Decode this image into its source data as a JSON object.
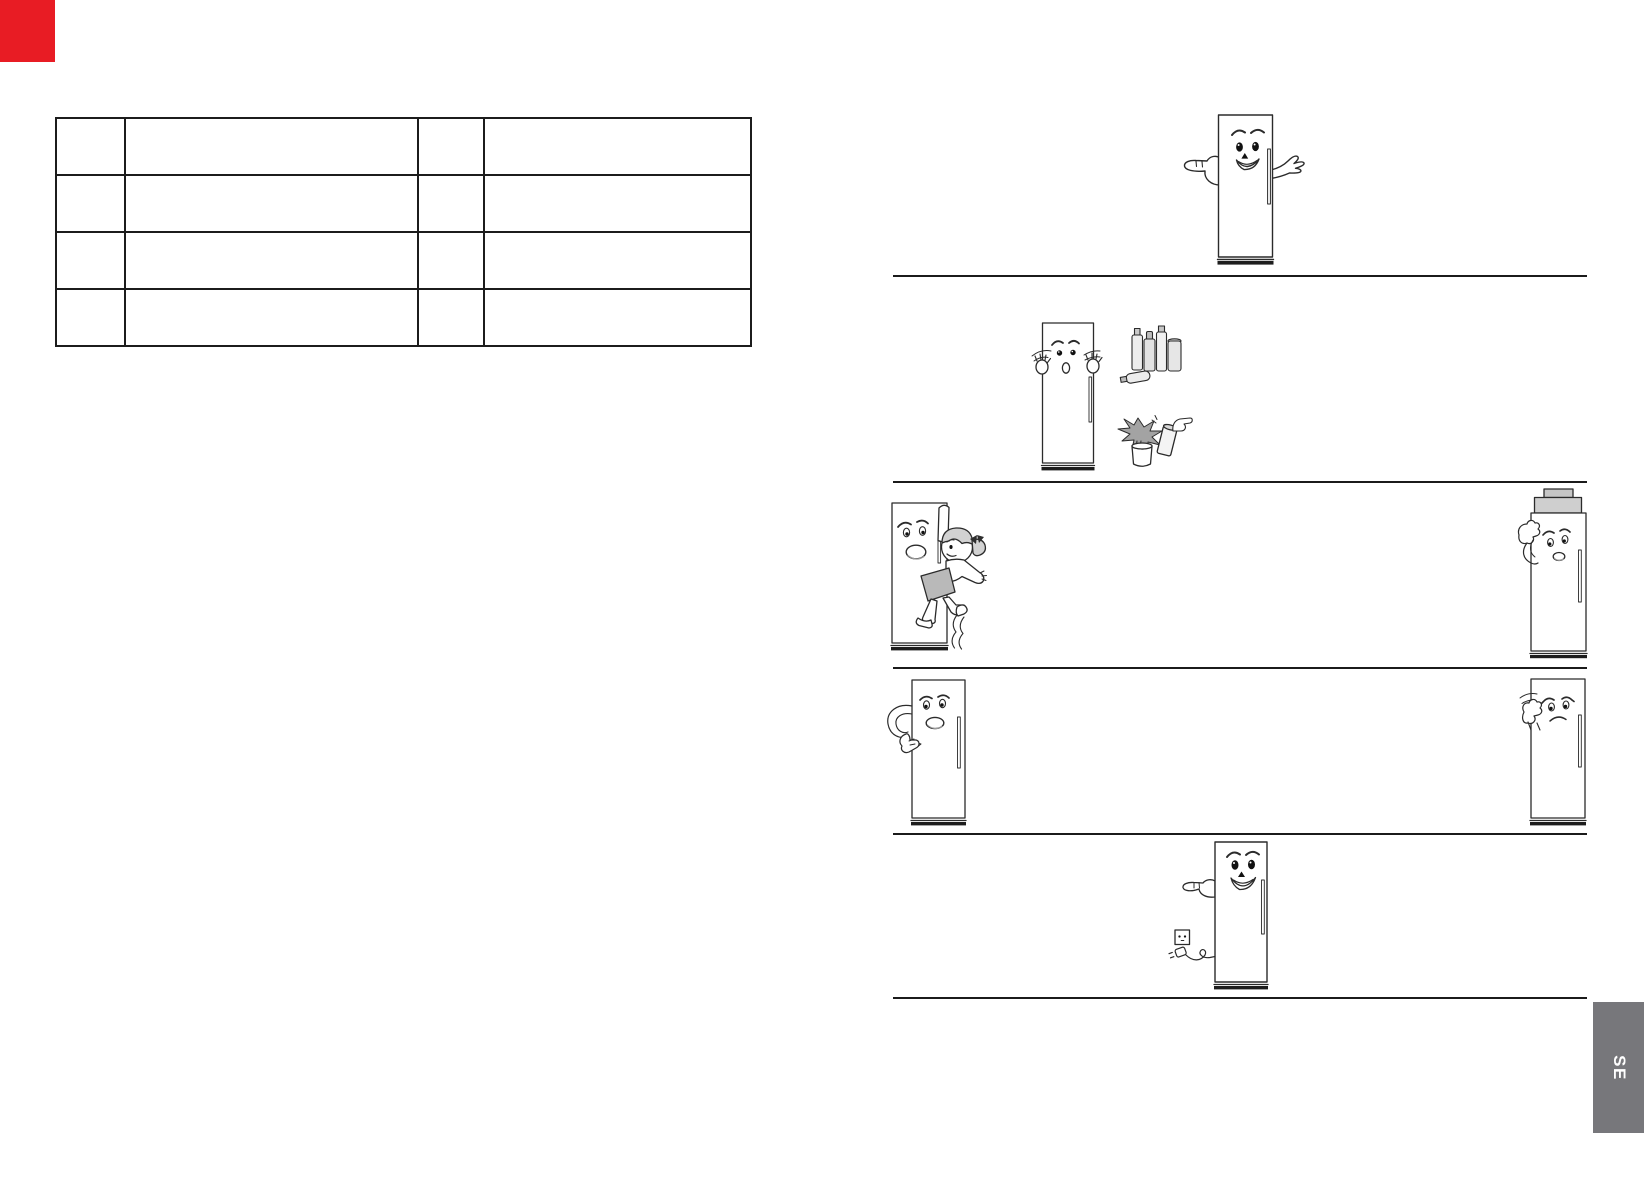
{
  "page": {
    "width": 1644,
    "height": 1191,
    "background": "#ffffff"
  },
  "corner_mark": {
    "color": "#e81c24"
  },
  "spec_table": {
    "rows": 4,
    "columns": 4,
    "cells": [
      [
        "",
        "",
        "",
        ""
      ],
      [
        "",
        "",
        "",
        ""
      ],
      [
        "",
        "",
        "",
        ""
      ],
      [
        "",
        "",
        "",
        ""
      ]
    ]
  },
  "dividers": {
    "count": 5,
    "color": "#1b1b1b"
  },
  "illustrations": [
    {
      "name": "fridge-mascot-presenting"
    },
    {
      "name": "fridge-mascot-flammable-sprays-and-plant"
    },
    {
      "name": "fridge-mascot-child-hanging-on-door"
    },
    {
      "name": "fridge-mascot-heavy-objects-on-top"
    },
    {
      "name": "fridge-mascot-arm-at-side"
    },
    {
      "name": "fridge-mascot-wiping-side"
    },
    {
      "name": "fridge-mascot-accessible-plug-and-socket"
    }
  ],
  "side_tab": {
    "label": "SE",
    "background": "#77777b",
    "text_color": "#ffffff"
  }
}
